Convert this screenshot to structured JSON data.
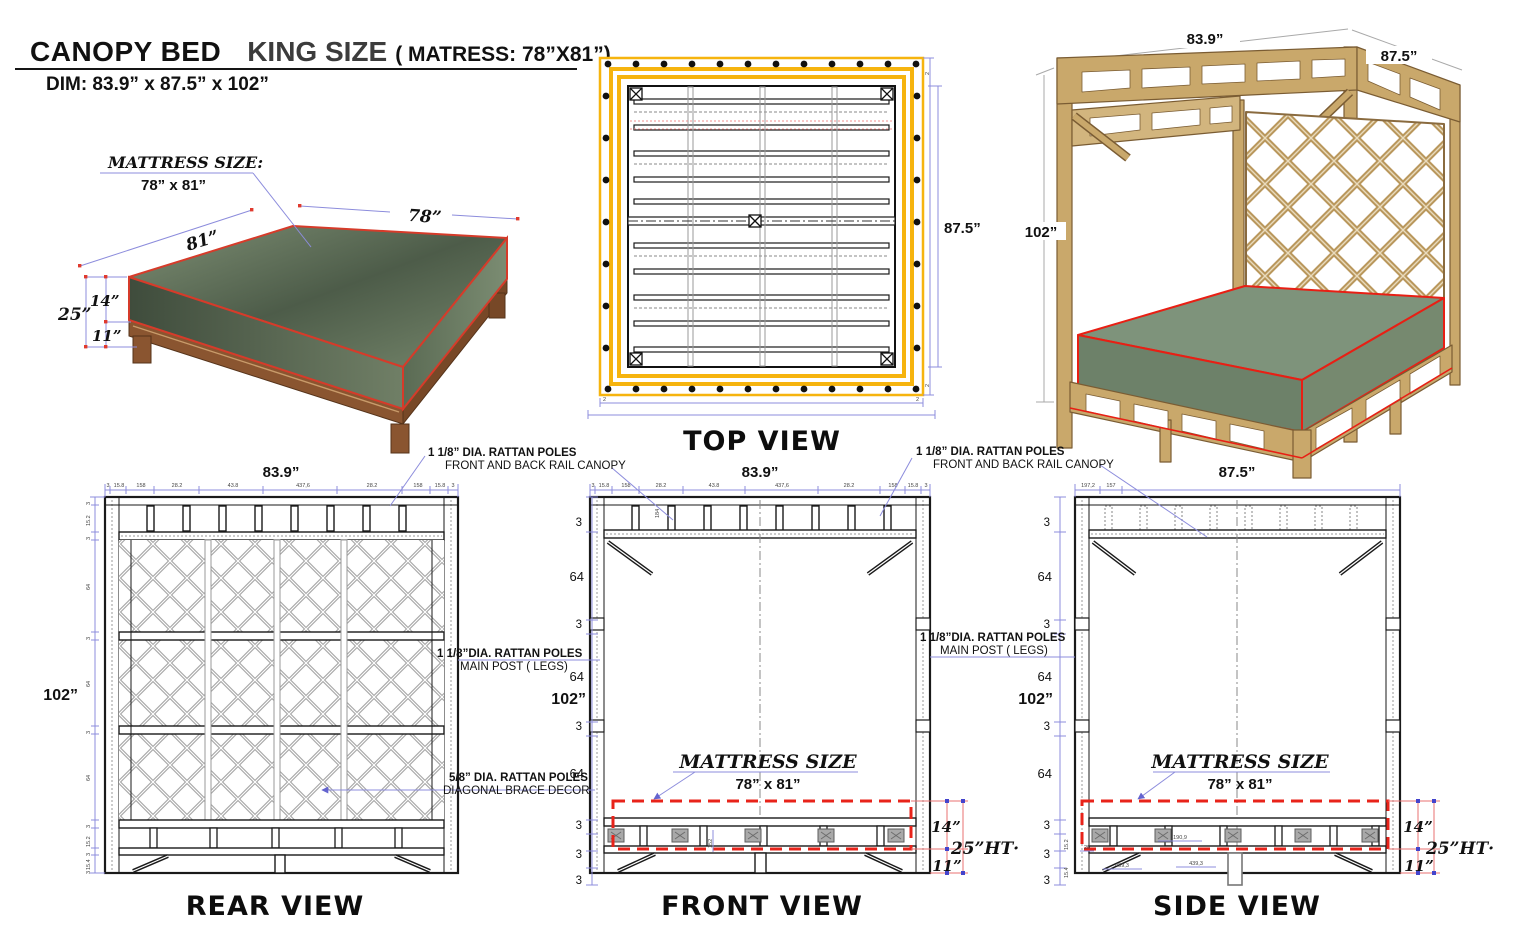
{
  "header": {
    "title": "CANOPY BED",
    "subtitle": "KING SIZE",
    "paren": "( MATRESS: 78”X81”)",
    "dim": "DIM: 83.9” x 87.5” x 102”"
  },
  "illustration": {
    "callout_title": "MATTRESS SIZE:",
    "callout_value": "78” x 81”",
    "dim_81": "81”",
    "dim_78": "78”",
    "dim_14": "14”",
    "dim_25": "25”",
    "dim_11": "11”"
  },
  "top_view": {
    "label": "TOP VIEW",
    "dim_right": "87.5”",
    "tick_small": "2"
  },
  "photo": {
    "dim_top": "83.9”",
    "dim_right": "87.5”",
    "dim_left": "102”"
  },
  "annotations": {
    "rail_canopy_1": "1 1/8” DIA. RATTAN POLES",
    "rail_canopy_2": "FRONT AND BACK RAIL CANOPY",
    "main_post_1": "1 1/8”DIA. RATTAN POLES",
    "main_post_2": "MAIN POST ( LEGS)",
    "brace_1": "5/8” DIA. RATTAN POLES",
    "brace_2": "DIAGONAL BRACE DECOR"
  },
  "views": {
    "rear": {
      "label": "REAR VIEW",
      "dim_top": "83.9”",
      "dim_left": "102”",
      "top_ticks": [
        "3",
        "15.8",
        "158",
        "28.2",
        "43.8",
        "437,6",
        "28.2",
        "158",
        "15.8",
        "3"
      ],
      "left_ticks": [
        "3",
        "15.2",
        "3",
        "64",
        "3",
        "64",
        "3",
        "64",
        "3",
        "15.2",
        "3",
        "15.4",
        "3"
      ]
    },
    "front": {
      "label": "FRONT VIEW",
      "dim_top": "83.9”",
      "dim_left": "102”",
      "top_ticks": [
        "3",
        "15.8",
        "158",
        "28.2",
        "43.8",
        "437,6",
        "28.2",
        "158",
        "15.8",
        "3"
      ],
      "left_chain": [
        "3",
        "64",
        "3",
        "64",
        "3",
        "64",
        "3",
        "3",
        "3"
      ],
      "callout_title": "MATTRESS SIZE",
      "callout_value": "78” x 81”",
      "dim_14": "14”",
      "dim_25": "25”HT·",
      "dim_11": "11”",
      "small_a": "184",
      "small_b": "152"
    },
    "side": {
      "label": "SIDE VIEW",
      "dim_top": "87.5”",
      "dim_left": "102”",
      "top_ticks": [
        "197,2",
        "157"
      ],
      "left_chain": [
        "3",
        "64",
        "3",
        "64",
        "3",
        "64",
        "3",
        "3",
        "3"
      ],
      "left_small": [
        "15.2",
        "15.4"
      ],
      "callout_title": "MATTRESS SIZE",
      "callout_value": "78” x 81”",
      "dim_14": "14”",
      "dim_25": "25”HT·",
      "dim_11": "11”",
      "small_20": "20",
      "small_1909": "190,9",
      "small_4393a": "439,3",
      "small_4393b": "439,3"
    }
  },
  "colors": {
    "dimension_blue": "#8c8cdc",
    "outline_red": "#e63226",
    "frame_yellow": "#f6b40e",
    "mattress_green": "#74876c",
    "rattan_tan": "#c9a86b",
    "ink": "#111111"
  }
}
